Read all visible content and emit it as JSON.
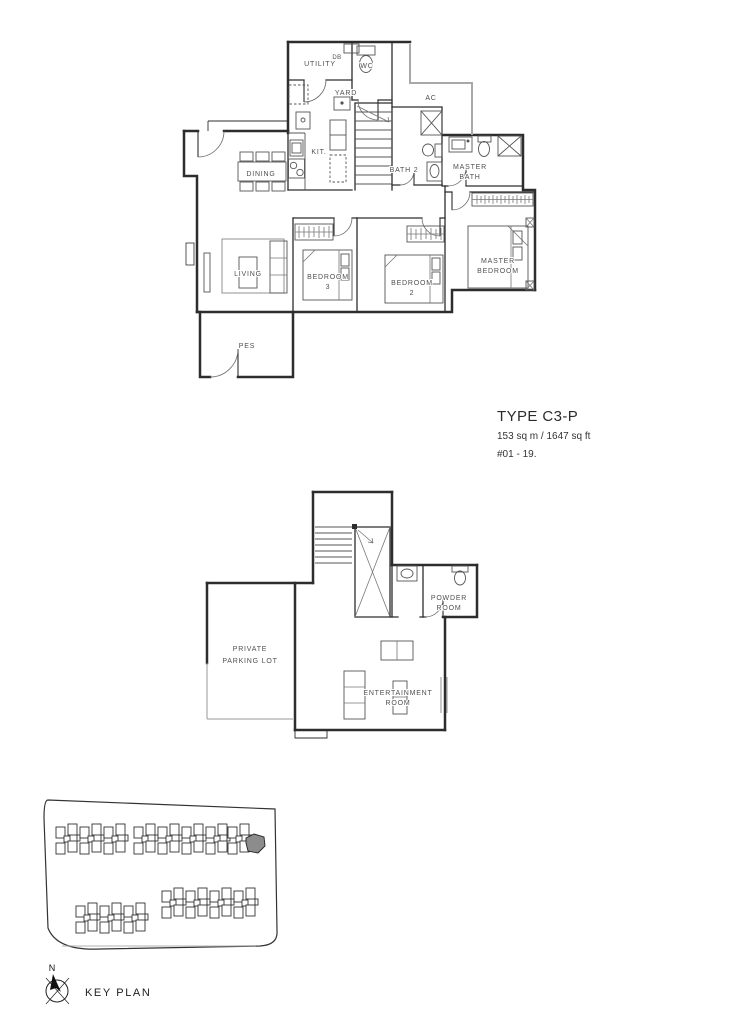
{
  "unit_info": {
    "type_name": "TYPE C3-P",
    "area": "153 sq m / 1647 sq ft",
    "levels": "#01 - 19."
  },
  "upper_floor": {
    "rooms": {
      "utility": "UTILITY",
      "db": "DB",
      "wc": "WC",
      "yard": "YARD",
      "ac": "AC",
      "kitchen": "KIT.",
      "dining": "DINING",
      "living": "LIVING",
      "pes": "PES",
      "bath2": "BATH 2",
      "master_bath": [
        "MASTER",
        "BATH"
      ],
      "bedroom3": [
        "BEDROOM",
        "3"
      ],
      "bedroom2": [
        "BEDROOM",
        "2"
      ],
      "master_bedroom": [
        "MASTER",
        "BEDROOM"
      ]
    }
  },
  "lower_floor": {
    "rooms": {
      "private_parking": [
        "PRIVATE",
        "PARKING LOT"
      ],
      "powder_room": [
        "POWDER",
        "ROOM"
      ],
      "entertainment_room": [
        "ENTERTAINMENT",
        "ROOM"
      ]
    }
  },
  "key_plan": {
    "label": "KEY PLAN",
    "north": "N"
  },
  "colors": {
    "wall": "#2d2d2d",
    "open_edge": "#a8a8a8",
    "furniture": "#555555",
    "label": "#4f4f4f",
    "highlight": "#8c8c8c"
  }
}
